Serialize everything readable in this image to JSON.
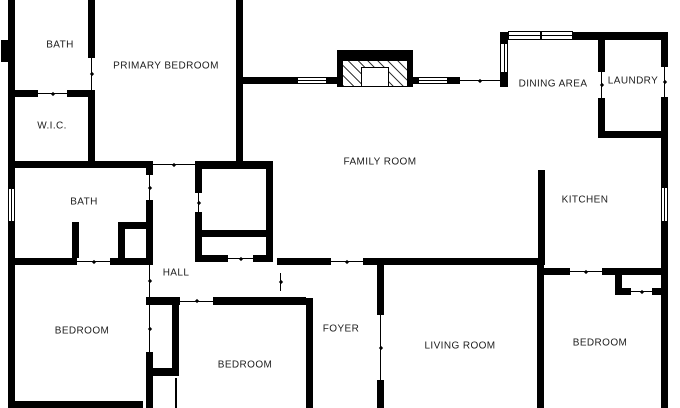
{
  "meta": {
    "type": "residential floor plan",
    "background_color": "#ffffff",
    "wall_color": "#000000",
    "label_color": "#1c1c1c"
  },
  "rooms": [
    {
      "id": "bath-primary",
      "label": "BATH",
      "cx": 60,
      "cy": 45
    },
    {
      "id": "primary-bedroom",
      "label": "PRIMARY BEDROOM",
      "cx": 166,
      "cy": 66
    },
    {
      "id": "wic",
      "label": "W.I.C.",
      "cx": 52,
      "cy": 126
    },
    {
      "id": "bath-hall",
      "label": "BATH",
      "cx": 84,
      "cy": 202
    },
    {
      "id": "hall",
      "label": "HALL",
      "cx": 176,
      "cy": 273
    },
    {
      "id": "family-room",
      "label": "FAMILY ROOM",
      "cx": 380,
      "cy": 162
    },
    {
      "id": "dining-area",
      "label": "DINING AREA",
      "cx": 553,
      "cy": 84
    },
    {
      "id": "laundry",
      "label": "LAUNDRY",
      "cx": 633,
      "cy": 81
    },
    {
      "id": "kitchen",
      "label": "KITCHEN",
      "cx": 585,
      "cy": 200
    },
    {
      "id": "bedroom-left",
      "label": "BEDROOM",
      "cx": 82,
      "cy": 331
    },
    {
      "id": "bedroom-center",
      "label": "BEDROOM",
      "cx": 245,
      "cy": 365
    },
    {
      "id": "foyer",
      "label": "FOYER",
      "cx": 341,
      "cy": 329
    },
    {
      "id": "living-room",
      "label": "LIVING ROOM",
      "cx": 460,
      "cy": 346
    },
    {
      "id": "bedroom-right",
      "label": "BEDROOM",
      "cx": 600,
      "cy": 343
    }
  ],
  "walls": [
    {
      "x": 8,
      "y": 0,
      "w": 7,
      "h": 188
    },
    {
      "x": 8,
      "y": 222,
      "w": 7,
      "h": 186
    },
    {
      "x": 1,
      "y": 40,
      "w": 7,
      "h": 22
    },
    {
      "x": 15,
      "y": 401,
      "w": 128,
      "h": 7
    },
    {
      "x": 88,
      "y": 0,
      "w": 7,
      "h": 58
    },
    {
      "x": 8,
      "y": 90,
      "w": 31,
      "h": 7
    },
    {
      "x": 67,
      "y": 90,
      "w": 28,
      "h": 7
    },
    {
      "x": 88,
      "y": 90,
      "w": 7,
      "h": 78
    },
    {
      "x": 236,
      "y": 0,
      "w": 7,
      "h": 168
    },
    {
      "x": 8,
      "y": 161,
      "w": 138,
      "h": 7
    },
    {
      "x": 146,
      "y": 161,
      "w": 7,
      "h": 14
    },
    {
      "x": 195,
      "y": 161,
      "w": 78,
      "h": 8
    },
    {
      "x": 195,
      "y": 169,
      "w": 7,
      "h": 24
    },
    {
      "x": 195,
      "y": 212,
      "w": 7,
      "h": 50
    },
    {
      "x": 266,
      "y": 169,
      "w": 7,
      "h": 93
    },
    {
      "x": 195,
      "y": 230,
      "w": 78,
      "h": 7
    },
    {
      "x": 195,
      "y": 255,
      "w": 33,
      "h": 7
    },
    {
      "x": 253,
      "y": 255,
      "w": 20,
      "h": 7
    },
    {
      "x": 236,
      "y": 77,
      "w": 61,
      "h": 7
    },
    {
      "x": 327,
      "y": 77,
      "w": 10,
      "h": 7
    },
    {
      "x": 412,
      "y": 77,
      "w": 6,
      "h": 7
    },
    {
      "x": 448,
      "y": 77,
      "w": 12,
      "h": 7
    },
    {
      "x": 500,
      "y": 73,
      "w": 8,
      "h": 14
    },
    {
      "x": 500,
      "y": 32,
      "w": 8,
      "h": 11
    },
    {
      "x": 573,
      "y": 32,
      "w": 95,
      "h": 8
    },
    {
      "x": 661,
      "y": 32,
      "w": 7,
      "h": 35
    },
    {
      "x": 661,
      "y": 97,
      "w": 7,
      "h": 90
    },
    {
      "x": 661,
      "y": 222,
      "w": 7,
      "h": 186
    },
    {
      "x": 598,
      "y": 32,
      "w": 7,
      "h": 40
    },
    {
      "x": 598,
      "y": 98,
      "w": 7,
      "h": 40
    },
    {
      "x": 598,
      "y": 131,
      "w": 70,
      "h": 7
    },
    {
      "x": 538,
      "y": 170,
      "w": 7,
      "h": 95
    },
    {
      "x": 277,
      "y": 258,
      "w": 54,
      "h": 7
    },
    {
      "x": 363,
      "y": 258,
      "w": 182,
      "h": 7
    },
    {
      "x": 543,
      "y": 268,
      "w": 27,
      "h": 7
    },
    {
      "x": 602,
      "y": 268,
      "w": 66,
      "h": 7
    },
    {
      "x": 615,
      "y": 275,
      "w": 7,
      "h": 20
    },
    {
      "x": 615,
      "y": 288,
      "w": 16,
      "h": 7
    },
    {
      "x": 652,
      "y": 288,
      "w": 16,
      "h": 7
    },
    {
      "x": 537,
      "y": 265,
      "w": 7,
      "h": 143
    },
    {
      "x": 377,
      "y": 265,
      "w": 7,
      "h": 50
    },
    {
      "x": 377,
      "y": 380,
      "w": 7,
      "h": 28
    },
    {
      "x": 306,
      "y": 298,
      "w": 7,
      "h": 110
    },
    {
      "x": 146,
      "y": 297,
      "w": 34,
      "h": 8
    },
    {
      "x": 213,
      "y": 297,
      "w": 93,
      "h": 8
    },
    {
      "x": 172,
      "y": 305,
      "w": 7,
      "h": 70
    },
    {
      "x": 146,
      "y": 368,
      "w": 33,
      "h": 8
    },
    {
      "x": 72,
      "y": 222,
      "w": 7,
      "h": 36
    },
    {
      "x": 118,
      "y": 222,
      "w": 7,
      "h": 36
    },
    {
      "x": 118,
      "y": 222,
      "w": 28,
      "h": 7
    },
    {
      "x": 146,
      "y": 200,
      "w": 7,
      "h": 58
    },
    {
      "x": 146,
      "y": 352,
      "w": 7,
      "h": 56
    },
    {
      "x": 15,
      "y": 258,
      "w": 62,
      "h": 7
    },
    {
      "x": 110,
      "y": 258,
      "w": 43,
      "h": 7
    }
  ],
  "thin_lines": [
    {
      "x": 175,
      "y": 378,
      "w": 2,
      "h": 30
    }
  ],
  "openings": [
    {
      "x": 38,
      "y": 90,
      "w": 29,
      "h": 7,
      "dir": "h"
    },
    {
      "x": 88,
      "y": 58,
      "w": 7,
      "h": 32,
      "dir": "v"
    },
    {
      "x": 153,
      "y": 161,
      "w": 42,
      "h": 7,
      "dir": "h"
    },
    {
      "x": 195,
      "y": 193,
      "w": 7,
      "h": 19,
      "dir": "v"
    },
    {
      "x": 228,
      "y": 255,
      "w": 25,
      "h": 7,
      "dir": "h"
    },
    {
      "x": 460,
      "y": 77,
      "w": 40,
      "h": 7,
      "dir": "h"
    },
    {
      "x": 598,
      "y": 72,
      "w": 7,
      "h": 26,
      "dir": "v"
    },
    {
      "x": 661,
      "y": 67,
      "w": 7,
      "h": 30,
      "dir": "v"
    },
    {
      "x": 331,
      "y": 258,
      "w": 32,
      "h": 7,
      "dir": "h"
    },
    {
      "x": 570,
      "y": 268,
      "w": 32,
      "h": 7,
      "dir": "h"
    },
    {
      "x": 631,
      "y": 288,
      "w": 21,
      "h": 7,
      "dir": "h"
    },
    {
      "x": 180,
      "y": 297,
      "w": 33,
      "h": 8,
      "dir": "h"
    },
    {
      "x": 77,
      "y": 258,
      "w": 33,
      "h": 7,
      "dir": "h"
    },
    {
      "x": 146,
      "y": 175,
      "w": 7,
      "h": 25,
      "dir": "v"
    },
    {
      "x": 146,
      "y": 265,
      "w": 7,
      "h": 32,
      "dir": "v"
    },
    {
      "x": 146,
      "y": 305,
      "w": 7,
      "h": 47,
      "dir": "v"
    },
    {
      "x": 277,
      "y": 273,
      "w": 7,
      "h": 18,
      "dir": "v"
    },
    {
      "x": 377,
      "y": 315,
      "w": 7,
      "h": 65,
      "dir": "v"
    }
  ],
  "windows": [
    {
      "x": 8,
      "y": 188,
      "w": 7,
      "h": 34,
      "dir": "v"
    },
    {
      "x": 297,
      "y": 77,
      "w": 30,
      "h": 7,
      "dir": "h"
    },
    {
      "x": 418,
      "y": 77,
      "w": 30,
      "h": 7,
      "dir": "h"
    },
    {
      "x": 508,
      "y": 31,
      "w": 33,
      "h": 9,
      "dir": "h"
    },
    {
      "x": 541,
      "y": 31,
      "w": 32,
      "h": 9,
      "dir": "h"
    },
    {
      "x": 500,
      "y": 43,
      "w": 8,
      "h": 30,
      "dir": "v"
    },
    {
      "x": 661,
      "y": 187,
      "w": 7,
      "h": 35,
      "dir": "v"
    }
  ],
  "fireplace": {
    "outer": {
      "x": 337,
      "y": 50,
      "w": 76,
      "h": 37
    },
    "hatch": {
      "x": 343,
      "y": 61,
      "w": 64,
      "h": 26
    },
    "firebox": {
      "x": 361,
      "y": 67,
      "w": 28,
      "h": 20
    }
  }
}
